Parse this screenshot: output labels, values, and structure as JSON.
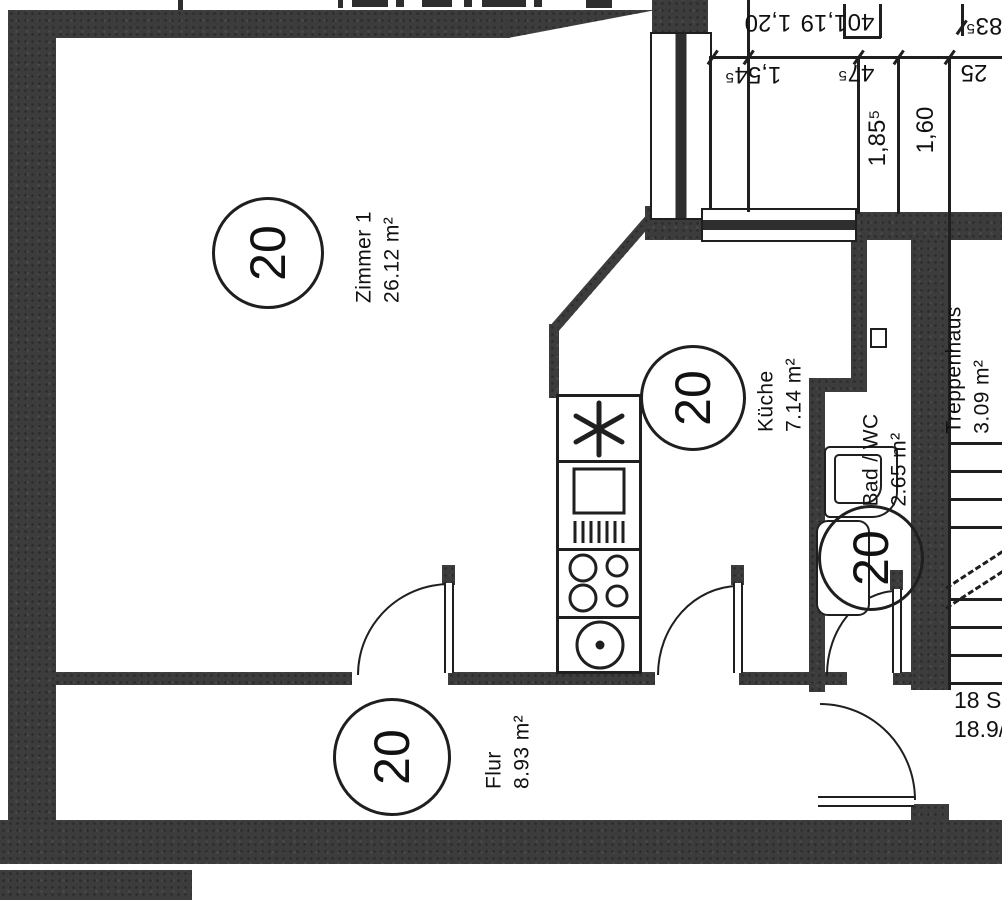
{
  "document_type": "apartment floor plan (scan)",
  "rooms": {
    "zimmer1": {
      "badge": "20",
      "name": "Zimmer 1",
      "area": "26.12 m²"
    },
    "kueche": {
      "badge": "20",
      "name": "Küche",
      "area": "7.14 m²"
    },
    "bad": {
      "badge": "20",
      "name": "Bad / WC",
      "area": "2.65 m²"
    },
    "flur": {
      "badge": "20",
      "name": "Flur",
      "area": "8.93 m²"
    },
    "treppenhaus": {
      "name": "Treppenhaus",
      "area": "3.09 m²"
    }
  },
  "dims": {
    "d120": "1,20",
    "d119": "1,19",
    "d40": "40",
    "d835": "83⁵",
    "d1545": "1,54⁵",
    "d475": "47⁵",
    "d25": "25",
    "d1855": "1,85⁵",
    "d160": "1,60"
  },
  "stairs": {
    "note1": "18 S",
    "note2": "18.9/"
  },
  "colors": {
    "wall": "#3c3c3c",
    "line": "#1f1f1f",
    "background": "#ffffff"
  }
}
